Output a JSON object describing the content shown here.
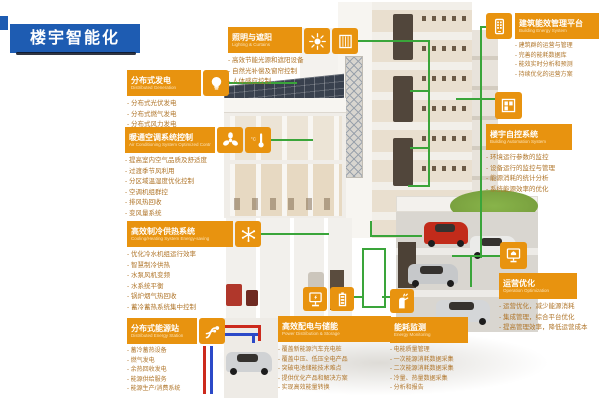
{
  "banner": {
    "title": "楼宇智能化"
  },
  "colors": {
    "banner_blue": "#1E5CB2",
    "accent_orange": "#E8930F",
    "connector_green": "#3AA53A",
    "pipe_red": "#CC2A1D",
    "pipe_blue": "#2B49C8",
    "bullet_text": "#B0762B",
    "car_red": "#C22B1A",
    "lawn_green": "#7BA33E"
  },
  "illustration": {
    "description": "isometric cutaway smart building with parking garage, solar roof and rooftop lawn"
  },
  "callouts": [
    {
      "id": "distributed-generation",
      "title": "分布式发电",
      "subtitle": "Distributed Generation",
      "icons": [
        "lightbulb-icon"
      ],
      "items": [
        "分布式光伏发电",
        "分布式燃气发电",
        "分布式风力发电"
      ]
    },
    {
      "id": "lighting-curtains",
      "title": "照明与遮阳",
      "subtitle": "Lighting & Curtains",
      "icons": [
        "sun-icon",
        "blinds-icon"
      ],
      "items": [
        "高效节能光源和遮阳设备",
        "自然光补偿及窗帘控制",
        "人体感应控制"
      ]
    },
    {
      "id": "hvac-control",
      "title": "暖通空调系统控制",
      "subtitle": "Air Conditioning System Optimized Control",
      "icons": [
        "fan-icon",
        "thermometer-icon"
      ],
      "icon_label": "°C",
      "items": [
        "提高室内空气品质及舒适度",
        "过渡季节风利用",
        "分区域温湿度优化控制",
        "空调机组群控",
        "排风热回收",
        "变风量系统"
      ]
    },
    {
      "id": "cooling-heating",
      "title": "高效制冷供热系统",
      "subtitle": "Cooling/Heating System Energy-saving",
      "icons": [
        "snowflake-icon"
      ],
      "items": [
        "优化冷水机组运行效率",
        "智慧制冷供热",
        "水泵风机变频",
        "水系统平衡",
        "锅炉烟气热回收",
        "蓄冷蓄热系统集中控制"
      ]
    },
    {
      "id": "distributed-energy-station",
      "title": "分布式能源站",
      "subtitle": "Distributed Energy Station",
      "icons": [
        "pipes-icon"
      ],
      "items": [
        "蓄冷蓄热设备",
        "燃气发电",
        "余热回收发电",
        "能源供给服务",
        "能源生产/消费系统"
      ]
    },
    {
      "id": "power-distribution-storage",
      "title": "高效配电与储能",
      "subtitle": "Power Distribution & Storage",
      "icons": [
        "ev-charger-icon",
        "battery-icon"
      ],
      "items": [
        "覆盖新能源汽车充电桩",
        "覆盖中压、低压全电产品",
        "突破电池储能技术难点",
        "提供优化产品和解决方案",
        "实现高效能量转换"
      ]
    },
    {
      "id": "energy-monitoring",
      "title": "能耗监测",
      "subtitle": "Energy Monitoring",
      "icons": [
        "charging-gun-icon"
      ],
      "items": [
        "电能质量管理",
        "一次能源消耗数据采集",
        "二次能源消耗数据采集",
        "冷量、热量数据采集",
        "分析和报告"
      ]
    },
    {
      "id": "building-energy-platform",
      "title": "建筑能效管理平台",
      "subtitle": "Building Energy System",
      "icons": [
        "smartphone-icon"
      ],
      "items": [
        "建筑群的运营与管理",
        "完善的能耗数据库",
        "能效实时分析和预测",
        "持续优化的运营方案"
      ]
    },
    {
      "id": "building-automation",
      "title": "楼宇自控系统",
      "subtitle": "Building Automation System",
      "icons": [
        "window-panels-icon"
      ],
      "items": [
        "环境运行参数的监控",
        "设备运行的监控与管理",
        "能源消耗的统计分析",
        "系统能源效率的优化"
      ]
    },
    {
      "id": "operation-optimization",
      "title": "运营优化",
      "subtitle": "Operation Optimization",
      "icons": [
        "monitor-house-icon"
      ],
      "items": [
        "运营优化，减少能源消耗",
        "集成管理，综合平台优化",
        "提高管理效率，降低运营成本"
      ]
    }
  ]
}
